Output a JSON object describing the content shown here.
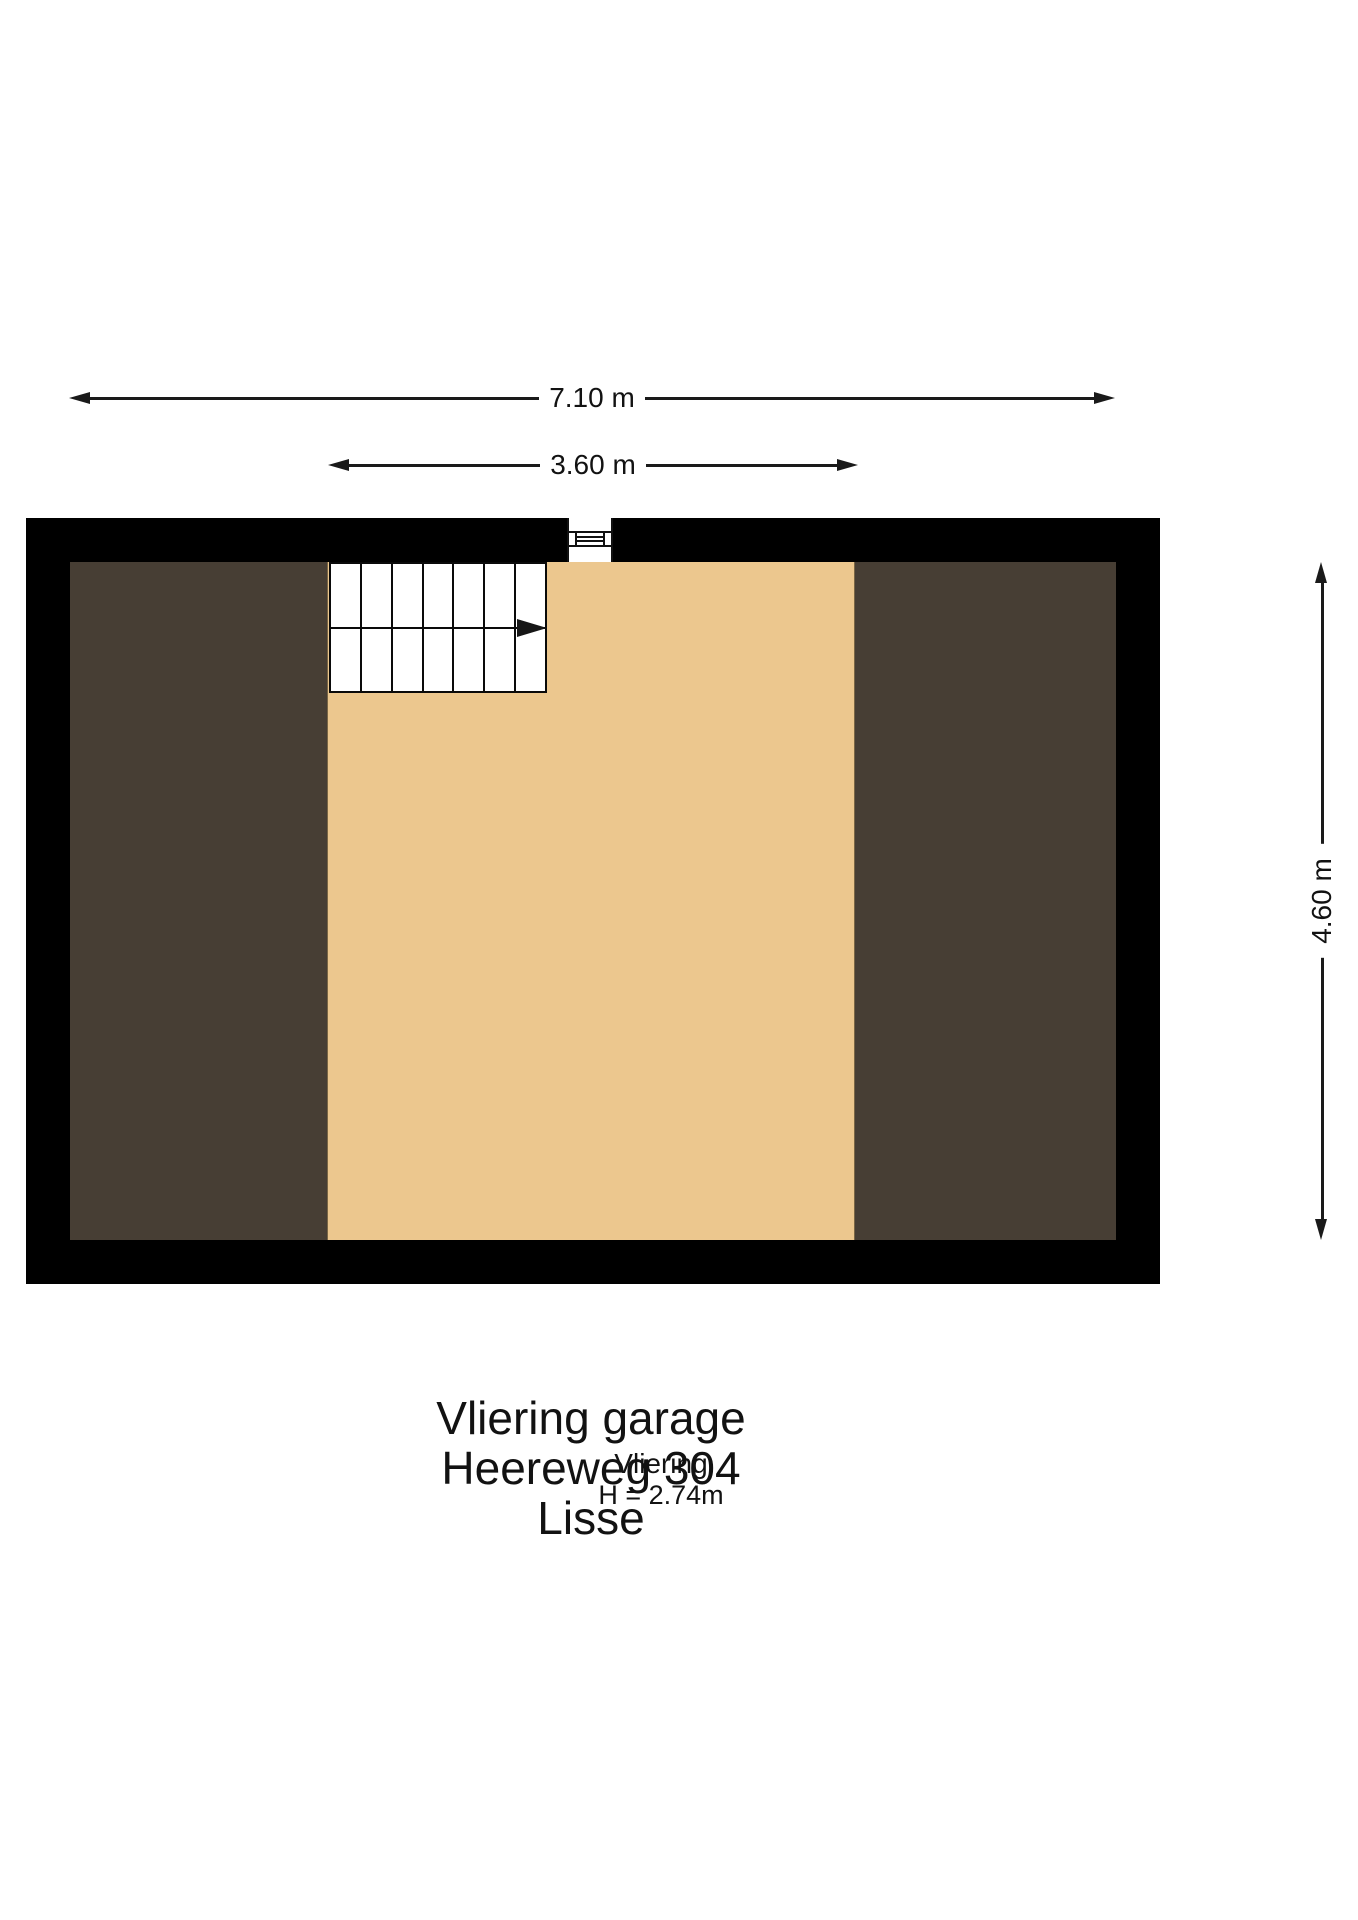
{
  "floorplan": {
    "dimensions": {
      "overall_width": "7.10 m",
      "vliering_width": "3.60 m",
      "overall_depth": "4.60 m"
    },
    "room": {
      "name": "Vliering",
      "ceiling_height": "H = 2.74m"
    },
    "stairs": {
      "rows": 2,
      "columns": 7
    },
    "icons": {
      "stairs_direction": "right-arrow-icon",
      "wall_opening": "window-icon"
    },
    "colors": {
      "wall": "#000000",
      "floor": "#ecc78e",
      "roof": "#473e34",
      "stair": "#ffffff",
      "line": "#1a1a1a"
    }
  },
  "caption": {
    "lines": [
      "Vliering garage",
      "Heereweg 304",
      "Lisse"
    ]
  }
}
